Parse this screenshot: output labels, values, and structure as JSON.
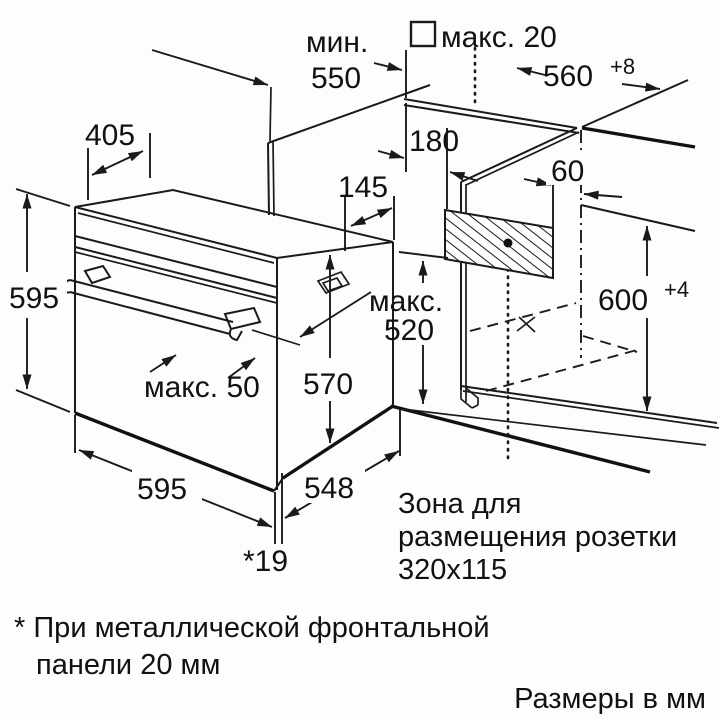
{
  "diagram_title": "Oven installation drawing",
  "dimensions": {
    "min_depth": {
      "prefix": "мин.",
      "value": "550"
    },
    "panel_max": {
      "value": "макс. 20"
    },
    "niche_width": {
      "value": "560",
      "tolerance": "+8"
    },
    "top_depth": {
      "value": "405"
    },
    "rear_offset": {
      "value": "180"
    },
    "vent_offset": {
      "value": "145"
    },
    "socket_offset": {
      "value": "60"
    },
    "oven_height": {
      "value": "595"
    },
    "niche_depth_max": {
      "prefix": "макс.",
      "value": "520"
    },
    "niche_height": {
      "value": "600",
      "tolerance": "+4"
    },
    "handle_max": {
      "value": "макс. 50"
    },
    "body_height": {
      "value": "570"
    },
    "oven_width": {
      "value": "595"
    },
    "body_depth": {
      "value": "548"
    },
    "door_offset": {
      "value": "*19"
    }
  },
  "socket_zone_label": {
    "line1": "Зона для",
    "line2": "размещения розетки",
    "line3": "320x115"
  },
  "footnote": {
    "line1": "* При металлической фронтальной",
    "line2": "панели 20 мм"
  },
  "units_label": "Размеры в мм"
}
